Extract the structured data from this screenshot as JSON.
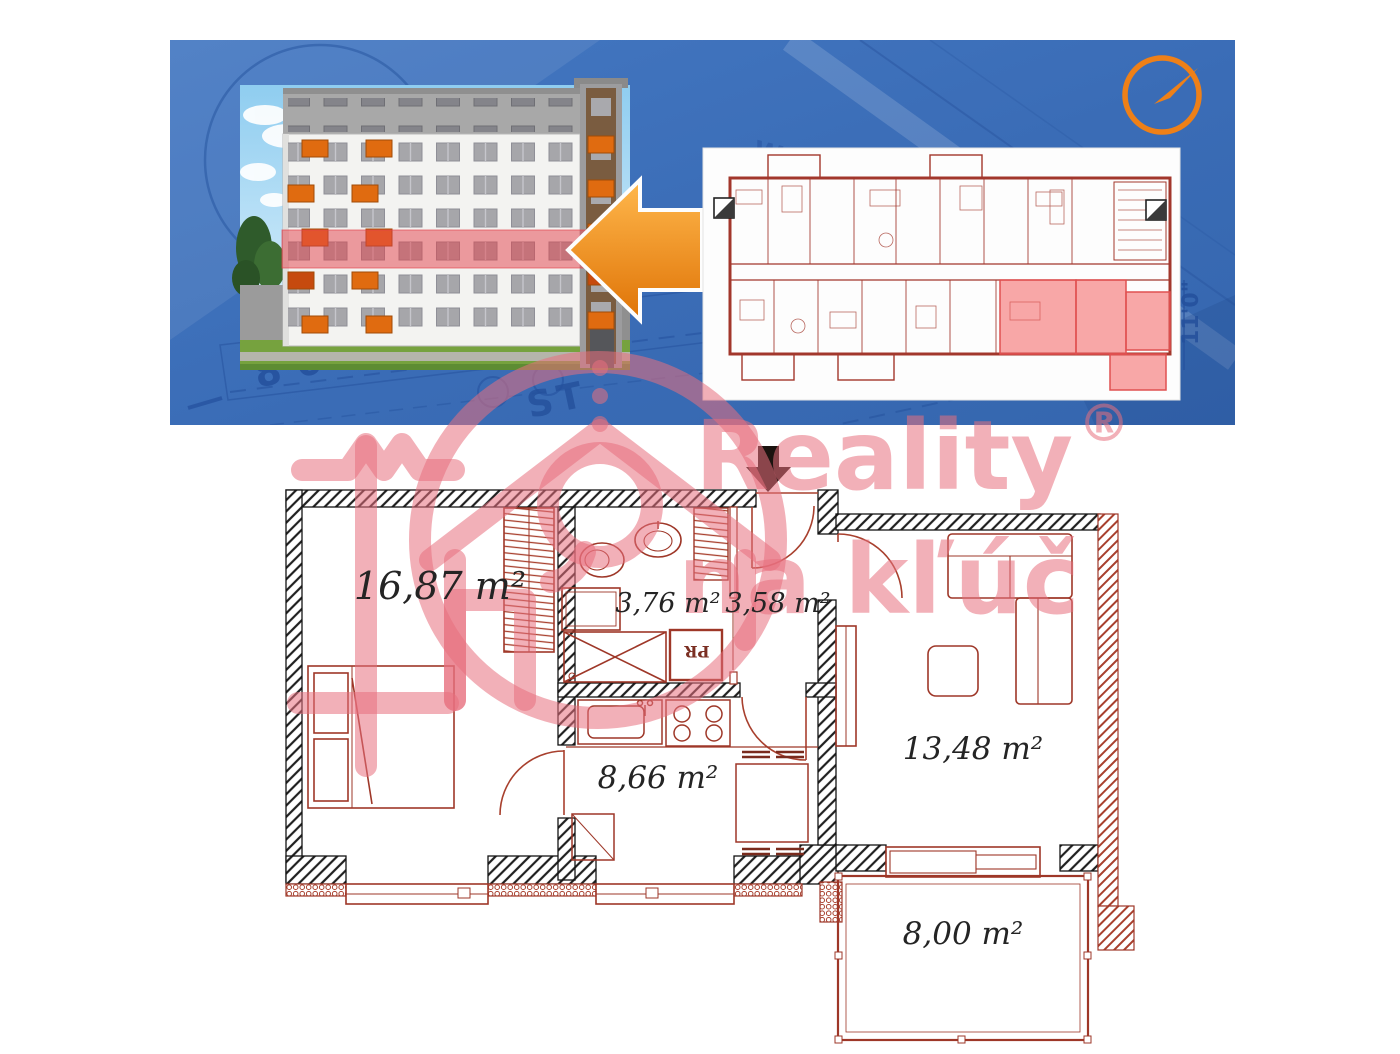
{
  "hero": {
    "annotations": {
      "dim_left": "8'0\"",
      "street": "ST",
      "compass_letter": "W",
      "dim_right": "11'0\""
    }
  },
  "watermark": {
    "brand": "Reality",
    "registered_mark": "®",
    "tagline": "na kľúč"
  },
  "floorplan": {
    "rooms": [
      {
        "id": "bedroom",
        "area": "16,87 m²"
      },
      {
        "id": "bathroom",
        "area": "3,76 m²"
      },
      {
        "id": "hall",
        "area": "3,58 m²"
      },
      {
        "id": "kitchen",
        "area": "8,66 m²"
      },
      {
        "id": "living-room",
        "area": "13,48 m²"
      },
      {
        "id": "terrace",
        "area": "8,00 m²"
      }
    ],
    "pantry_label": "PR"
  },
  "colors": {
    "blueprint_blue": "#3d6fb8",
    "blueprint_line_dark": "#24509c",
    "accent_orange": "#ee8018",
    "plan_red": "#9e3728",
    "highlight_red": "#f05a5a",
    "watermark_pink": "#f2aab4"
  }
}
